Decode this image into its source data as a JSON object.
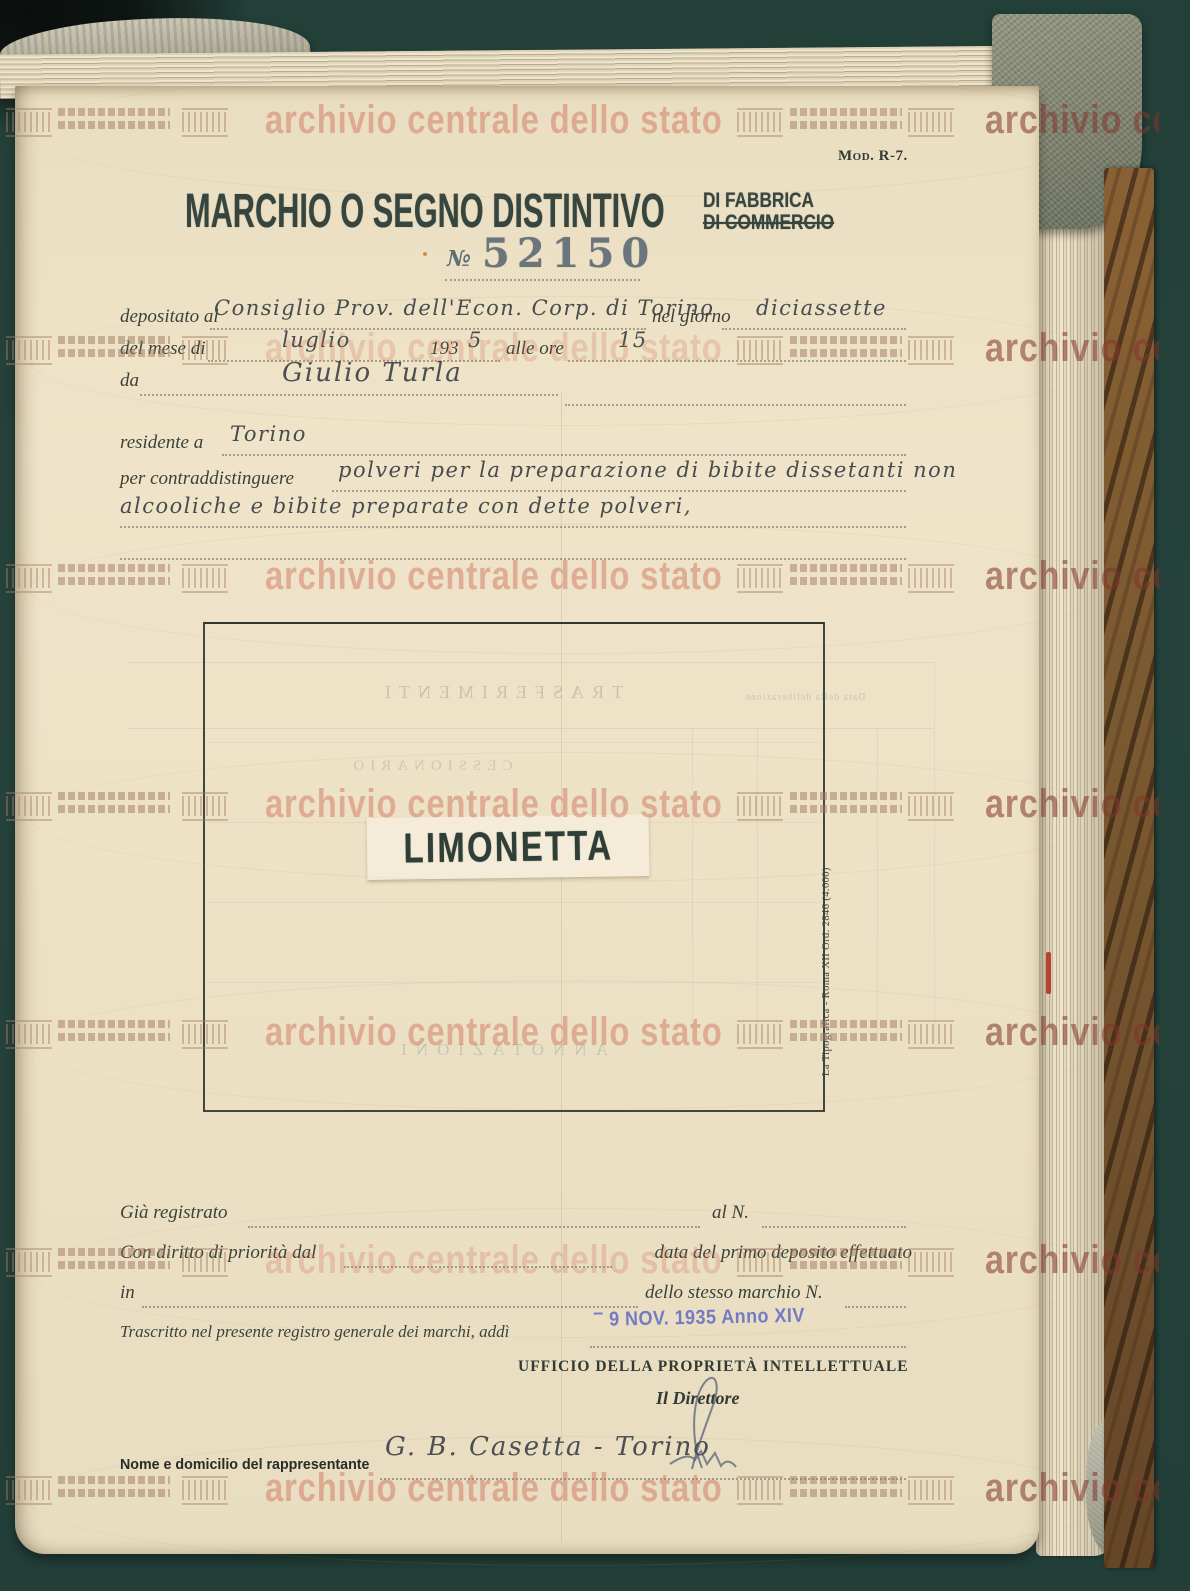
{
  "watermark": {
    "text": "archivio centrale dello stato"
  },
  "header": {
    "mod_label": "Mod. R-7.",
    "title": "MARCHIO O SEGNO DISTINTIVO",
    "subtitle_fabbrica": "DI FABBRICA",
    "subtitle_commercio": "DI COMMERCIO",
    "number_symbol": "№",
    "number": "52150"
  },
  "form": {
    "depositato_label": "depositato al",
    "depositato_value": "Consiglio Prov. dell'Econ. Corp. di Torino",
    "nel_giorno_label": "nel giorno",
    "giorno_value": "diciassette",
    "del_mese_label": "del mese di",
    "mese_value": "luglio",
    "year_printed": "193",
    "year_digit": "5",
    "alle_ore_label": "alle ore",
    "ore_value": "15",
    "da_label": "da",
    "da_value": "Giulio Turla",
    "residente_label": "residente a",
    "residente_value": "Torino",
    "scopo_label": "per contraddistinguere",
    "scopo_line1": "polveri per la preparazione di bibite dissetanti non",
    "scopo_line2": "alcooliche e bibite preparate con dette polveri,"
  },
  "mark": {
    "name": "LIMONETTA"
  },
  "printer_note": "La Tipografica - Roma XII Ord. 2846 (4.000)",
  "reg": {
    "gia_label": "Già registrato",
    "al_n_label": "al N.",
    "priorita_label": "Con diritto di priorità dal",
    "data_primo_label": "data del primo deposito effettuato",
    "in_label": "in",
    "marchio_n_label": "dello stesso marchio N.",
    "trascritto_label": "Trascritto nel presente registro generale dei marchi, addì",
    "stamp_prefix": "–",
    "stamp_date": "9 NOV. 1935 Anno XIV"
  },
  "office": {
    "name": "UFFICIO DELLA PROPRIETÀ INTELLETTUALE",
    "director": "Il Direttore"
  },
  "rep": {
    "label": "Nome e domicilio del rappresentante",
    "value": "G. B. Casetta - Torino"
  },
  "show": {
    "trasferimenti": "TRASFERIMENTI",
    "cessionario": "CESSIONARIO",
    "data_delib": "Data della deliberazione",
    "annotazioni": "ANNOTAZIONI"
  },
  "colors": {
    "paper": "#ece0c4",
    "ink": "#3b4139",
    "watermark_pink": "#d8826e",
    "stamp_blue": "#6a74c4",
    "background_teal": "#24423a",
    "binding_brown": "#7c5a31",
    "mark_ink": "#2f3e37",
    "number_ink": "#5f6d76",
    "red_mark": "#b22a1e"
  }
}
